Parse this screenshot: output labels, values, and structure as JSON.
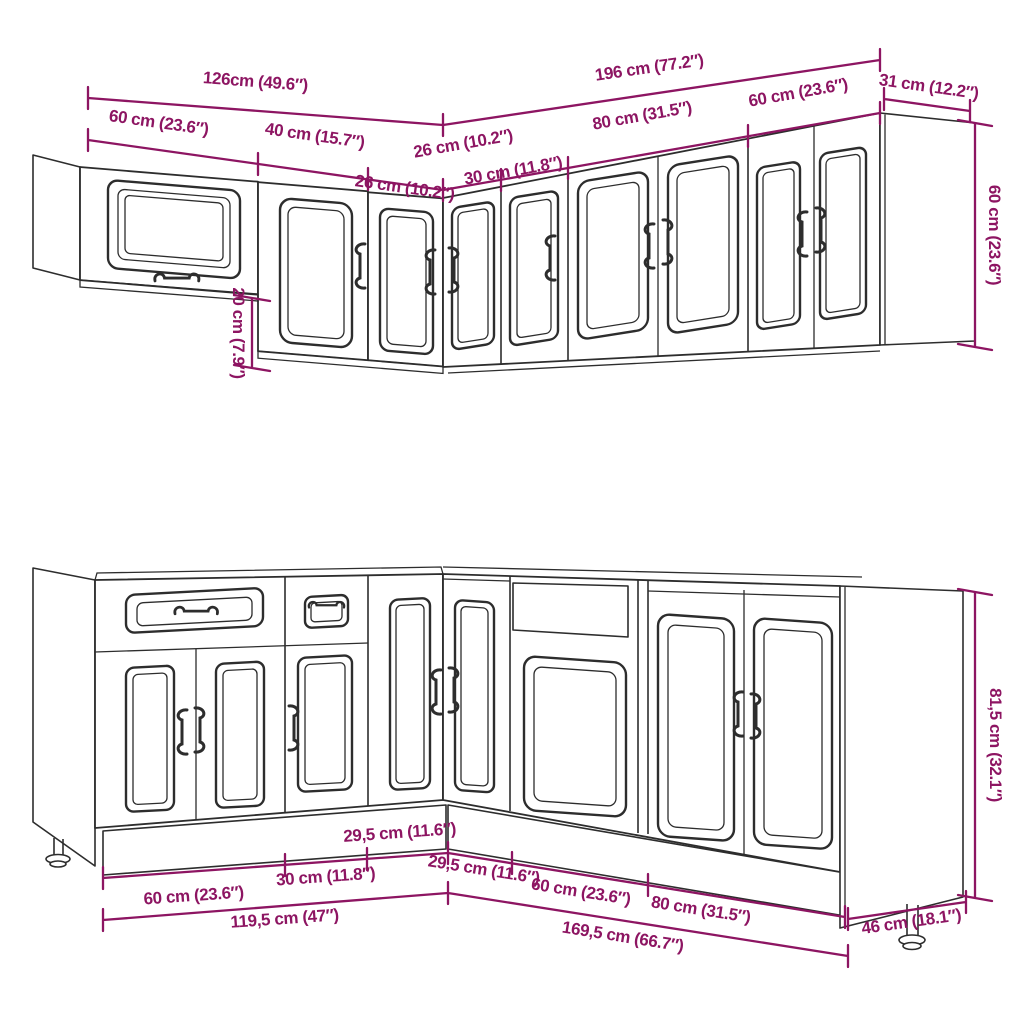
{
  "colors": {
    "dimension": "#8D1562",
    "line": "#2D2D2D",
    "background": "#FFFFFF"
  },
  "dims": {
    "upper": {
      "total_left": "126cm (49.6″)",
      "total_right": "196 cm (77.2″)",
      "end_depth": "31 cm (12.2″)",
      "unit_60_left": "60 cm (23.6″)",
      "unit_40": "40 cm (15.7″)",
      "unit_26_left": "26 cm (10.2″)",
      "unit_26_right": "26 cm (10.2″)",
      "unit_30": "30 cm (11.8″)",
      "unit_80": "80 cm (31.5″)",
      "unit_60_right": "60 cm (23.6″)",
      "height": "60 cm (23.6″)",
      "left_cabinet_offset": "20 cm (7.9″)"
    },
    "lower": {
      "unit_60_left": "60 cm (23.6″)",
      "unit_30": "30 cm (11.8″)",
      "unit_295_left": "29,5 cm (11.6″)",
      "unit_295_right": "29,5 cm (11.6″)",
      "unit_60_right": "60 cm (23.6″)",
      "unit_80": "80 cm (31.5″)",
      "total_left": "119,5 cm (47″)",
      "total_right": "169,5 cm (66.7″)",
      "end_depth": "46 cm (18.1″)",
      "height": "81,5 cm (32.1″)"
    }
  }
}
